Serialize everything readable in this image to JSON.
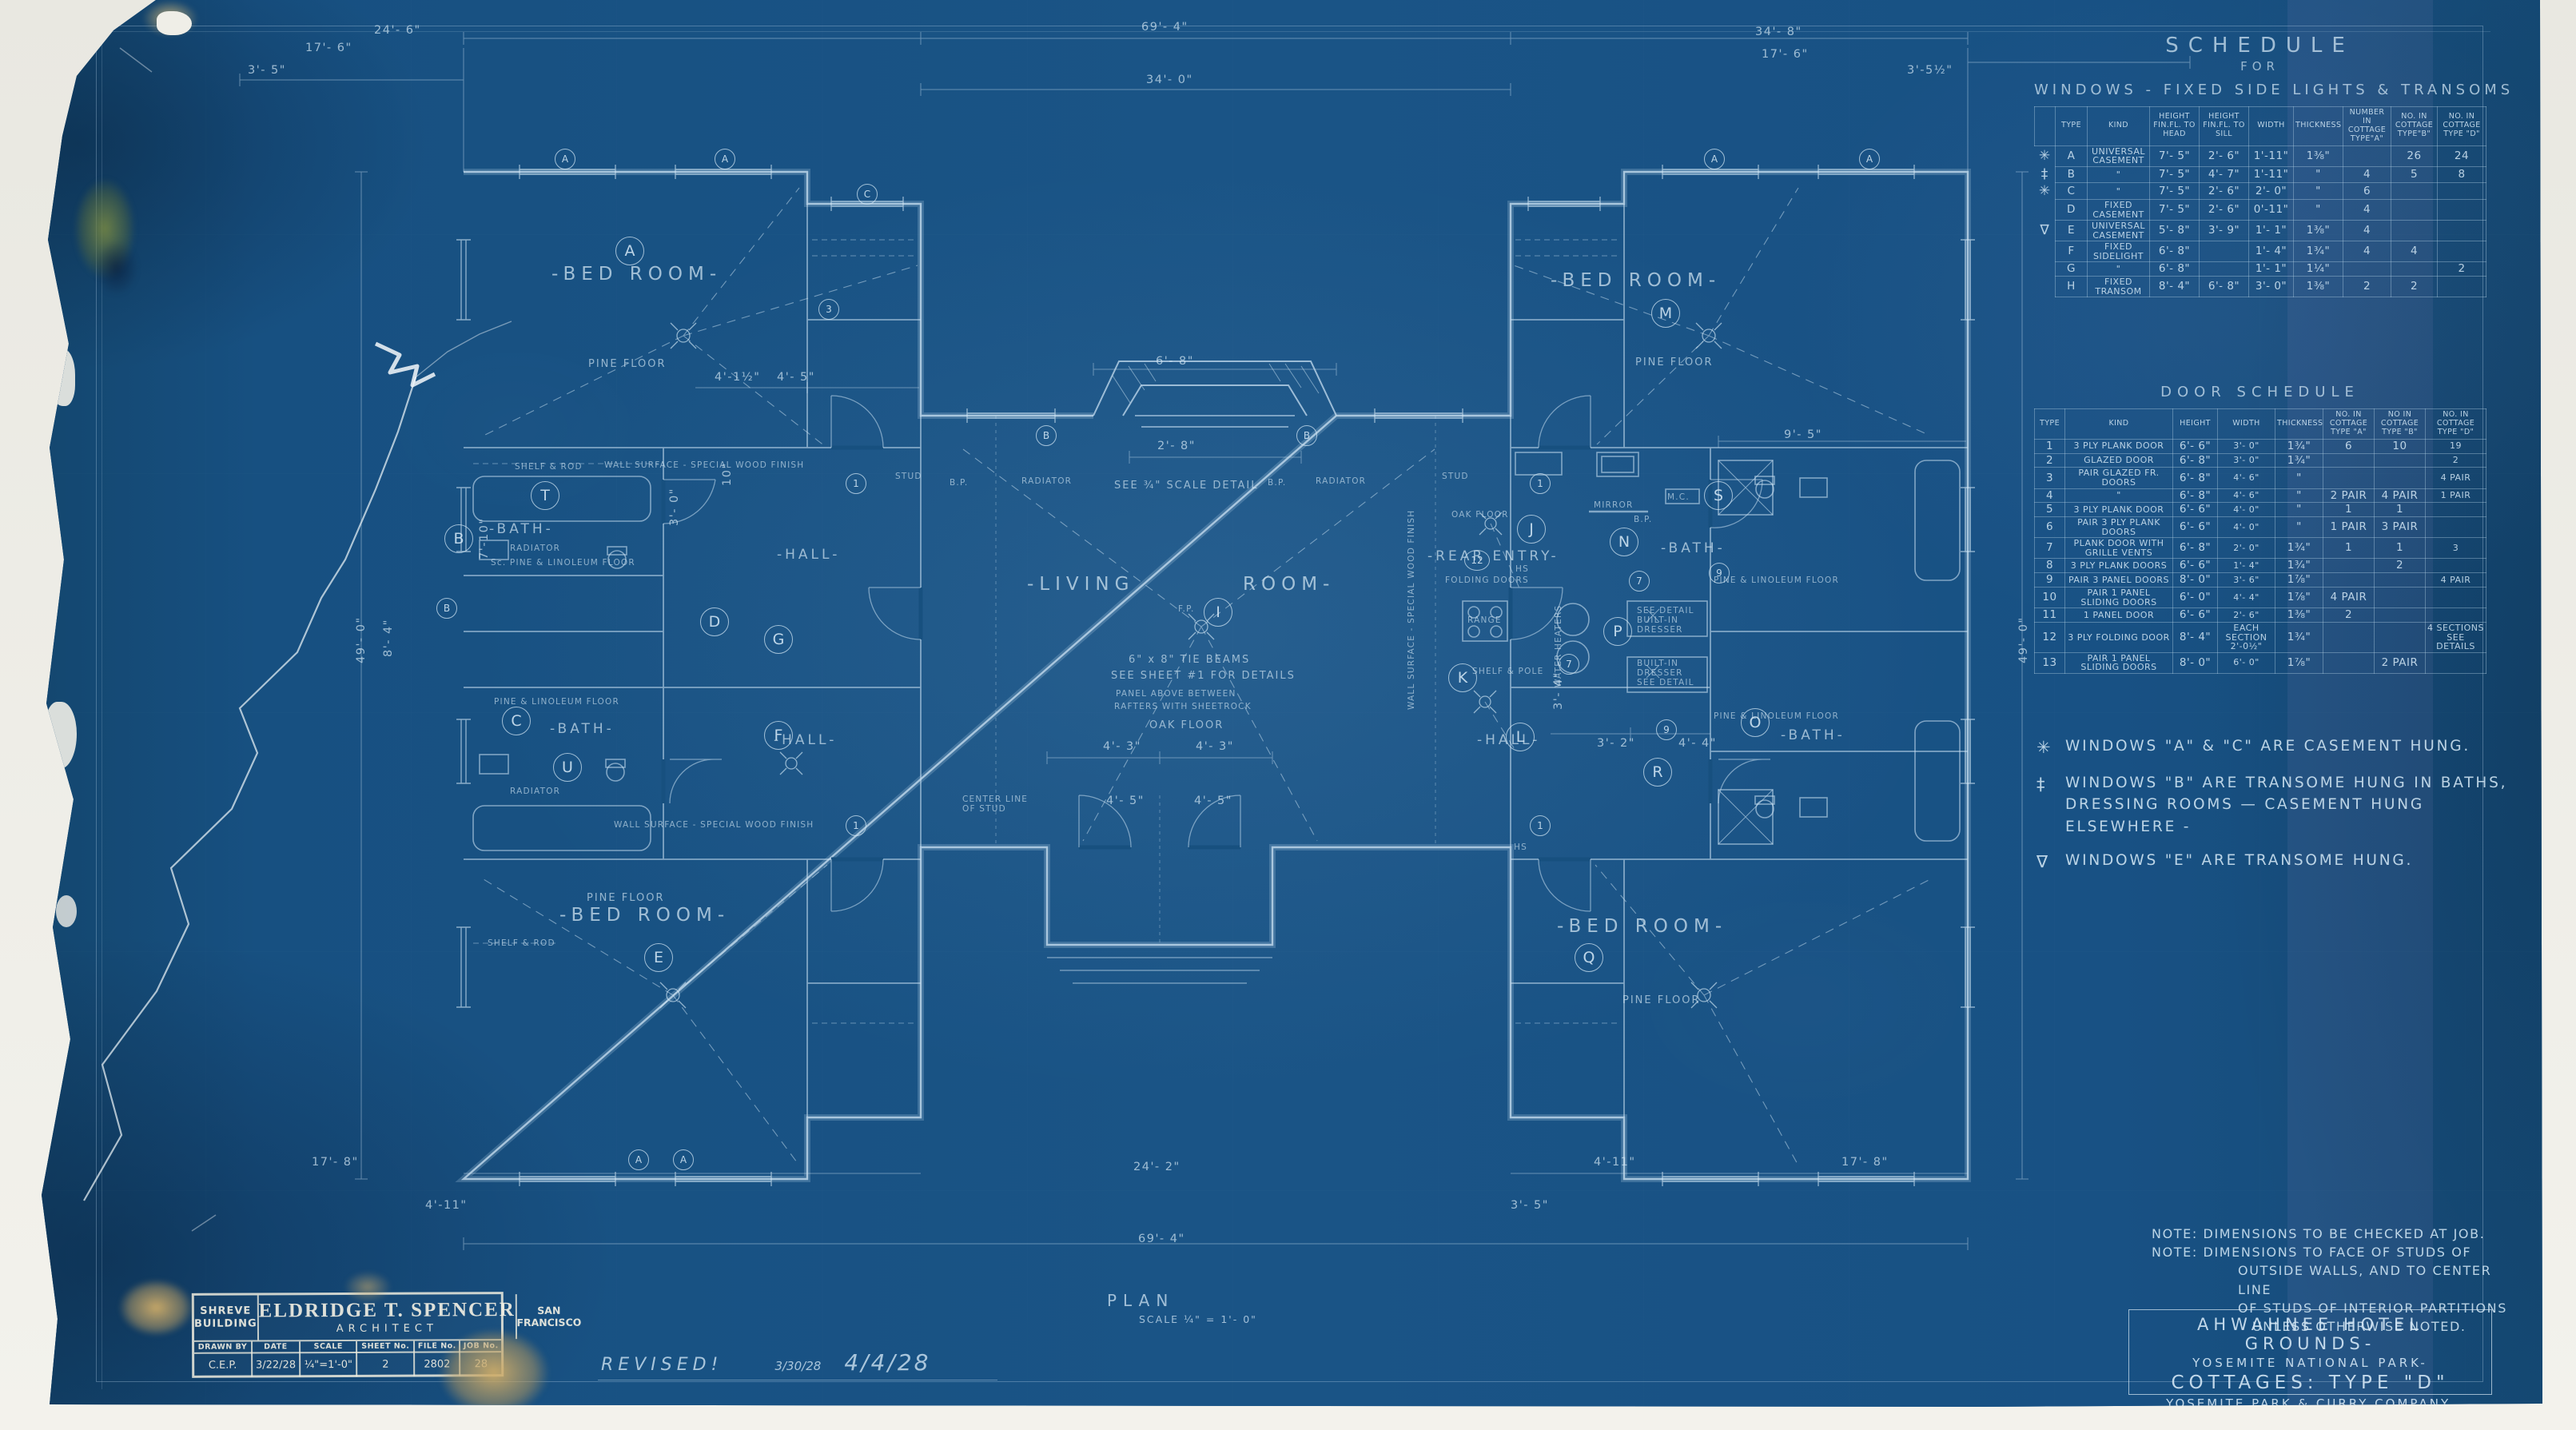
{
  "plan": {
    "rooms": {
      "bed_room": "-BED ROOM-",
      "living_left": "-LIVING",
      "living_right": "ROOM-",
      "rear_entry": "-REAR ENTRY-",
      "bath": "-BATH-",
      "hall": "-HALL-"
    },
    "circles": {
      "a": "A",
      "b": "B",
      "c": "C",
      "d": "D",
      "e": "E",
      "f": "F",
      "g": "G",
      "t": "T",
      "u": "U",
      "i": "I",
      "j": "J",
      "k": "K",
      "l": "L",
      "m": "M",
      "n": "N",
      "o": "O",
      "p": "P",
      "q": "Q",
      "r": "R",
      "s": "S"
    },
    "doornums": {
      "n1": "1",
      "n3": "3",
      "n7": "7",
      "n9": "9",
      "n12": "12"
    },
    "ann": {
      "pine_floor": "PINE FLOOR",
      "oak_floor": "OAK FLOOR",
      "radiator": "RADIATOR",
      "mirror": "MIRROR",
      "range": "RANGE",
      "folding_doors": "FOLDING DOORS",
      "shelf_pole": "SHELF & POLE",
      "shelf_rod": "SHELF & ROD",
      "water_heaters": "WATER HEATERS",
      "built_in_1": "SEE DETAIL\nBUILT-IN\nDRESSER",
      "built_in_2": "BUILT-IN\nDRESSER\nSEE DETAIL",
      "wall_surface": "WALL SURFACE - SPECIAL WOOD FINISH",
      "tie_beams_1": "6\" x 8\" TIE BEAMS",
      "tie_beams_2": "SEE SHEET #1 FOR DETAILS",
      "panel_above_1": "PANEL ABOVE BETWEEN",
      "panel_above_2": "RAFTERS WITH SHEETROCK",
      "see_scale_detail": "SEE ¾\" SCALE DETAIL",
      "fp": "F.P.",
      "bp": "B.P.",
      "hs": "HS",
      "mc": "M.C.",
      "stud": "STUD",
      "center_line": "CENTER LINE\nOF STUD",
      "pine_linoleum": "PINE & LINOLEUM FLOOR",
      "sc_pine_linoleum": "Sc. PINE & LINOLEUM FLOOR"
    },
    "dims": {
      "d69_4": "69'- 4\"",
      "d34_0": "34'- 0\"",
      "d34_8": "34'- 8\"",
      "d24_6": "24'- 6\"",
      "d24_2": "24'- 2\"",
      "d17_6": "17'- 6\"",
      "d17_8": "17'- 8\"",
      "d49_0": "49'- 0\"",
      "d8_4": "8'- 4\"",
      "d7_10": "7'-10\"",
      "d4_11": "4'-11\"",
      "d4_5": "4'- 5\"",
      "d4_4": "4'- 4\"",
      "d4_3": "4'- 3\"",
      "d4_1h": "4'-1½\"",
      "d3_5": "3'- 5\"",
      "d3_5h": "3'-5½\"",
      "d3_4": "3'- 4\"",
      "d3_2": "3'- 2\"",
      "d3_0": "3'- 0\"",
      "d2_8": "2'- 8\"",
      "d6_8": "6'- 8\"",
      "d9_5": "9'- 5\"",
      "d10": "10\""
    },
    "plan_label": {
      "title": "PLAN",
      "scale": "SCALE ¼\" = 1'- 0\""
    }
  },
  "window_schedule": {
    "title": "SCHEDULE",
    "for_word": "FOR",
    "heading": "WINDOWS  -  FIXED SIDE LIGHTS  &  TRANSOMS",
    "columns": [
      "",
      "TYPE",
      "KIND",
      "HEIGHT FIN.FL. TO HEAD",
      "HEIGHT FIN.FL. TO SILL",
      "WIDTH",
      "THICKNESS",
      "NUMBER IN COTTAGE TYPE\"A\"",
      "NO. IN COTTAGE TYPE\"B\"",
      "NO. IN COTTAGE TYPE \"D\""
    ],
    "rows": [
      [
        "✳",
        "A",
        "UNIVERSAL CASEMENT",
        "7'- 5\"",
        "2'- 6\"",
        "1'-11\"",
        "1⅜\"",
        "",
        "26",
        "24"
      ],
      [
        "‡",
        "B",
        "\"",
        "7'- 5\"",
        "4'- 7\"",
        "1'-11\"",
        "\"",
        "4",
        "5",
        "8"
      ],
      [
        "✳",
        "C",
        "\"",
        "7'- 5\"",
        "2'- 6\"",
        "2'- 0\"",
        "\"",
        "6",
        "",
        ""
      ],
      [
        "",
        "D",
        "FIXED CASEMENT",
        "7'- 5\"",
        "2'- 6\"",
        "0'-11\"",
        "\"",
        "4",
        "",
        ""
      ],
      [
        "∇",
        "E",
        "UNIVERSAL CASEMENT",
        "5'- 8\"",
        "3'- 9\"",
        "1'- 1\"",
        "1⅜\"",
        "4",
        "",
        ""
      ],
      [
        "",
        "F",
        "FIXED SIDELIGHT",
        "6'- 8\"",
        "",
        "1'- 4\"",
        "1¾\"",
        "4",
        "4",
        ""
      ],
      [
        "",
        "G",
        "\"",
        "6'- 8\"",
        "",
        "1'- 1\"",
        "1¼\"",
        "",
        "",
        "2"
      ],
      [
        "",
        "H",
        "FIXED TRANSOM",
        "8'- 4\"",
        "6'- 8\"",
        "3'- 0\"",
        "1⅜\"",
        "2",
        "2",
        ""
      ]
    ]
  },
  "door_schedule": {
    "title": "DOOR SCHEDULE",
    "columns": [
      "TYPE",
      "KIND",
      "HEIGHT",
      "WIDTH",
      "THICKNESS",
      "NO. IN COTTAGE TYPE \"A\"",
      "NO IN COTTAGE TYPE \"B\"",
      "NO. IN COTTAGE TYPE \"D\""
    ],
    "rows": [
      [
        "1",
        "3 PLY PLANK DOOR",
        "6'- 6\"",
        "3'- 0\"",
        "1¾\"",
        "6",
        "10",
        "19"
      ],
      [
        "2",
        "GLAZED DOOR",
        "6'- 8\"",
        "3'- 0\"",
        "1¾\"",
        "",
        "",
        "2"
      ],
      [
        "3",
        "PAIR GLAZED FR. DOORS",
        "6'- 8\"",
        "4'- 6\"",
        "\"",
        "",
        "",
        "4 PAIR"
      ],
      [
        "4",
        "\"",
        "6'- 8\"",
        "4'- 6\"",
        "\"",
        "2 PAIR",
        "4 PAIR",
        "1 PAIR"
      ],
      [
        "5",
        "3 PLY PLANK DOOR",
        "6'- 6\"",
        "4'- 0\"",
        "\"",
        "1",
        "1",
        ""
      ],
      [
        "6",
        "PAIR 3 PLY PLANK DOORS",
        "6'- 6\"",
        "4'- 0\"",
        "\"",
        "1 PAIR",
        "3 PAIR",
        ""
      ],
      [
        "7",
        "PLANK DOOR WITH GRILLE VENTS",
        "6'- 8\"",
        "2'- 0\"",
        "1¾\"",
        "1",
        "1",
        "3"
      ],
      [
        "8",
        "3 PLY PLANK DOORS",
        "6'- 6\"",
        "1'- 4\"",
        "1¾\"",
        "",
        "2",
        ""
      ],
      [
        "9",
        "PAIR 3 PANEL DOORS",
        "8'- 0\"",
        "3'- 6\"",
        "1⅞\"",
        "",
        "",
        "4 PAIR"
      ],
      [
        "10",
        "PAIR 1 PANEL SLIDING DOORS",
        "6'- 0\"",
        "4'- 4\"",
        "1⅞\"",
        "4 PAIR",
        "",
        ""
      ],
      [
        "11",
        "1 PANEL DOOR",
        "6'- 6\"",
        "2'- 6\"",
        "1⅜\"",
        "2",
        "",
        ""
      ],
      [
        "12",
        "3 PLY FOLDING DOOR",
        "8'- 4\"",
        "EACH SECTION 2'-0½\"",
        "1¾\"",
        "",
        "",
        "4 SECTIONS SEE DETAILS"
      ],
      [
        "13",
        "PAIR 1 PANEL SLIDING DOORS",
        "8'- 0\"",
        "6'- 0\"",
        "1⅞\"",
        "",
        "2 PAIR",
        ""
      ]
    ]
  },
  "hang_notes": [
    [
      "✳",
      "WINDOWS \"A\" & \"C\" ARE CASEMENT HUNG."
    ],
    [
      "‡",
      "WINDOWS \"B\" ARE TRANSOME HUNG IN BATHS, DRESSING ROOMS — CASEMENT HUNG ELSEWHERE -"
    ],
    [
      "∇",
      "WINDOWS \"E\" ARE TRANSOME HUNG."
    ]
  ],
  "bottom_notes": {
    "note1": "NOTE:  DIMENSIONS TO BE CHECKED AT JOB.",
    "note2a": "NOTE:  DIMENSIONS TO FACE OF STUDS OF",
    "note2b": "OUTSIDE WALLS, AND TO CENTER LINE",
    "note2c": "OF STUDS OF INTERIOR PARTITIONS",
    "note2d": "UNLESS OTHERWISE NOTED."
  },
  "project_block": {
    "line1": "AHWAHNEE HOTEL GROUNDS-",
    "line2": "YOSEMITE NATIONAL PARK-",
    "line3": "COTTAGES: TYPE \"D\"",
    "line4": "YOSEMITE PARK & CURRY COMPANY."
  },
  "stamp": {
    "office": "SHREVE BUILDING",
    "name": "ELDRIDGE T. SPENCER",
    "title": "ARCHITECT",
    "city": "SAN FRANCISCO",
    "fields": [
      {
        "label": "DRAWN BY",
        "value": "C.E.P."
      },
      {
        "label": "DATE",
        "value": "3/22/28"
      },
      {
        "label": "SCALE",
        "value": "¼\"=1'-0\""
      },
      {
        "label": "SHEET No.",
        "value": "2"
      },
      {
        "label": "FILE No.",
        "value": "2802"
      },
      {
        "label": "JOB No.",
        "value": "28"
      }
    ]
  },
  "revision": {
    "word": "REVISED!",
    "date1": "3/30/28",
    "date2": "4/4/28"
  }
}
